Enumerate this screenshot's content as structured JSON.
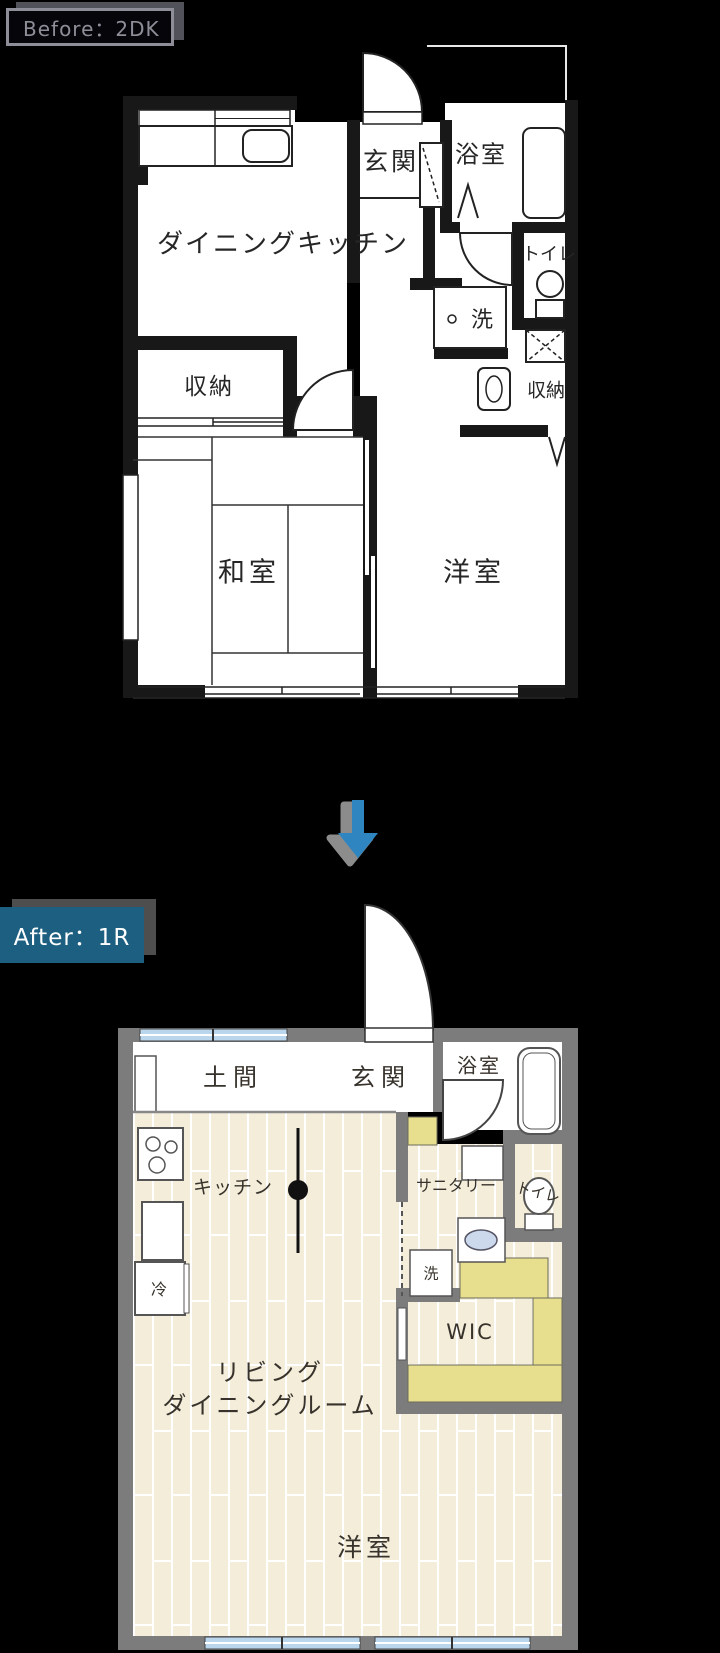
{
  "colors": {
    "background": "#000000",
    "before_wall": "#181818",
    "after_wall": "#7c7c7c",
    "floor_cream": "#f3edda",
    "closet_yellow": "#e7df8e",
    "window_blue": "#b9d6ec",
    "basin_blue": "#ccd9ec",
    "tag_teal": "#1d5f80",
    "arrow_blue": "#2e85c0",
    "arrow_shadow": "#8c8c8c"
  },
  "before": {
    "tag": "Before：2DK",
    "rooms": {
      "dining_kitchen": "ダイニングキッチン",
      "entrance": "玄関",
      "bathroom": "浴室",
      "toilet": "トイレ",
      "laundry": "洗",
      "storage_left": "収納",
      "storage_right": "収納",
      "japanese_room": "和室",
      "western_room": "洋室"
    }
  },
  "after": {
    "tag": "After：1R",
    "rooms": {
      "doma": "土間",
      "entrance": "玄関",
      "bathroom": "浴室",
      "kitchen": "キッチン",
      "sanitary": "サニタリー",
      "toilet": "トイレ",
      "laundry": "洗",
      "wic": "WIC",
      "fridge": "冷",
      "living_line1": "リビング",
      "living_line2": "ダイニングルーム",
      "western_room": "洋室"
    }
  }
}
